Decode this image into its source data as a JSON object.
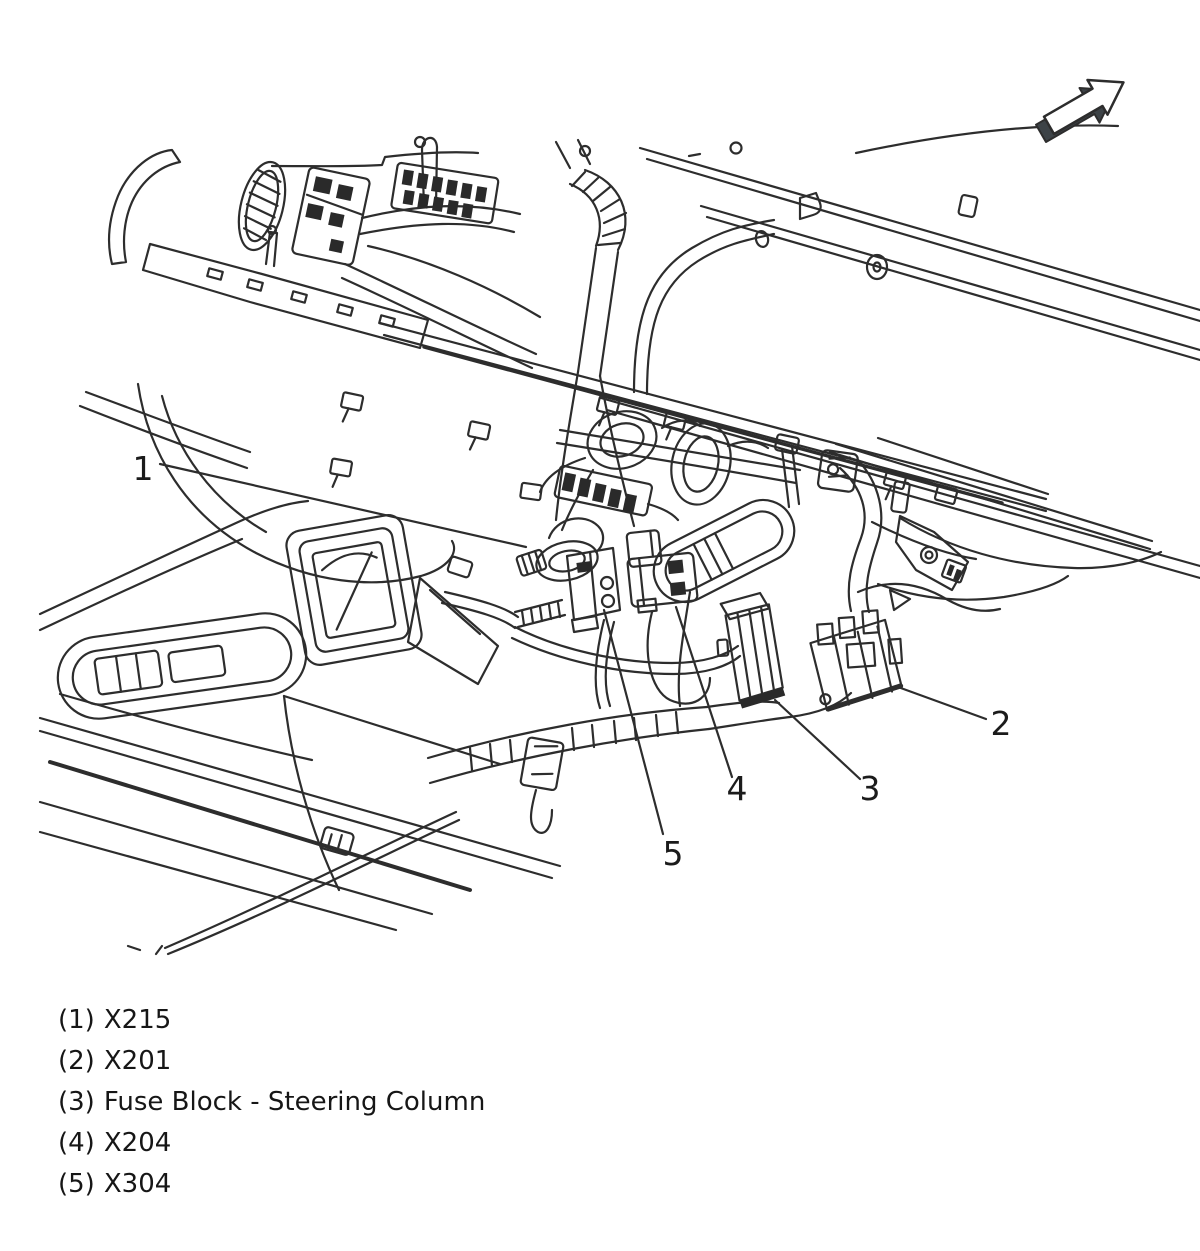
{
  "figure": {
    "callouts": [
      {
        "number": "1"
      },
      {
        "number": "2"
      },
      {
        "number": "3"
      },
      {
        "number": "4"
      },
      {
        "number": "5"
      }
    ],
    "legend": [
      {
        "marker": "(1)",
        "label": "X215"
      },
      {
        "marker": "(2)",
        "label": "X201"
      },
      {
        "marker": "(3)",
        "label": "Fuse Block - Steering Column"
      },
      {
        "marker": "(4)",
        "label": "X204"
      },
      {
        "marker": "(5)",
        "label": "X304"
      }
    ],
    "icons": [
      {
        "name": "forward-direction-arrow-icon",
        "shape": "3d-block-arrow-up-right"
      }
    ],
    "colors": {
      "ink": "#2d2d2d",
      "dark_fill": "#2a2a2a",
      "arrow_face": "#3d4347",
      "background": "#ffffff"
    }
  }
}
